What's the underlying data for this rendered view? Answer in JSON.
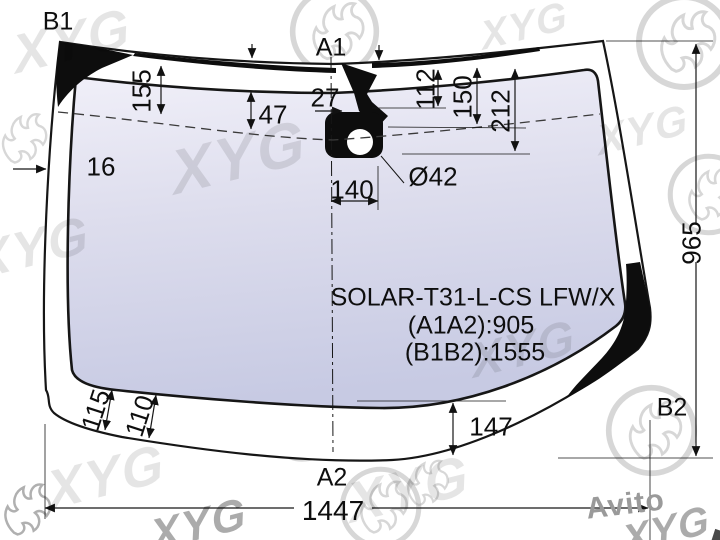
{
  "title_block": {
    "part_code": "SOLAR-T31-L-CS LFW/X",
    "dim_a1a2": "(A1A2):905",
    "dim_b1b2": "(B1B2):1555"
  },
  "corner_labels": {
    "top_left": "B1",
    "top_center": "A1",
    "bottom_center": "A2",
    "bottom_right": "B2"
  },
  "dimensions": {
    "d155": "155",
    "d47": "47",
    "d27": "27",
    "d112": "112",
    "d150": "150",
    "d212": "212",
    "d16": "16",
    "d140": "140",
    "hole_diameter": "Ø42",
    "d965": "965",
    "d115": "115",
    "d110": "110",
    "d147": "147",
    "d1447": "1447"
  },
  "watermarks": {
    "brand": "XYG",
    "marketplace": "Avito"
  },
  "colors": {
    "line": "#111111",
    "frit_black": "#0d0d0d",
    "glass_top": "#f1f0f9",
    "glass_mid": "#dddded",
    "glass_bottom": "#c7cae3",
    "watermark_gray": "#a7a7a7"
  }
}
